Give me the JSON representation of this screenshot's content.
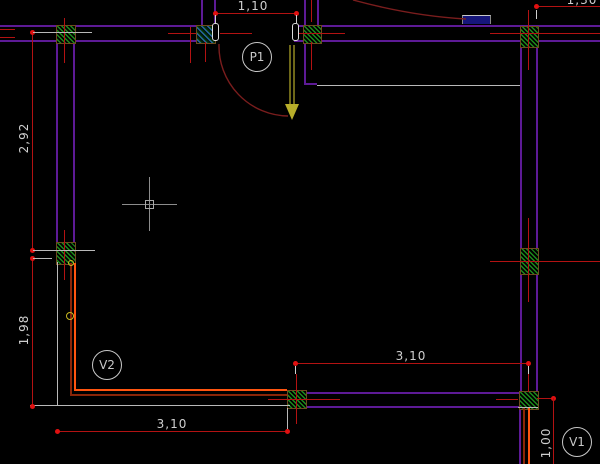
{
  "canvas": {
    "width": 600,
    "height": 464,
    "background": "#000000",
    "type": "cad-floor-plan"
  },
  "colors": {
    "wall": "#5d1a96",
    "dimension_line": "#b31212",
    "dimension_point": "#e01010",
    "dimension_text": "#cfcfcf",
    "extension_line": "#b9b9b9",
    "column_hatch_green": "#1c8a1c",
    "column_hatch_blue": "#2a6abf",
    "window_bright": "#ff5510",
    "window_dark": "#8a2508",
    "door_leaf": "#b8ae2a",
    "door_swing_arc": "#7a1d1d",
    "door_stop_fill": "#16167a",
    "tag_stroke": "#c8c8c8",
    "cursor": "#8c8c8c"
  },
  "dimensions": {
    "door_width": {
      "label": "1,10"
    },
    "top_right_width": {
      "label": "1,30"
    },
    "left_upper_height": {
      "label": "2,92"
    },
    "left_lower_height": {
      "label": "1,98"
    },
    "bottom_left_width": {
      "label": "3,10"
    },
    "bottom_right_width": {
      "label": "3,10"
    },
    "right_lower_height": {
      "label": "1,00"
    }
  },
  "tags": {
    "door": "P1",
    "window_left": "V2",
    "window_right": "V1"
  }
}
